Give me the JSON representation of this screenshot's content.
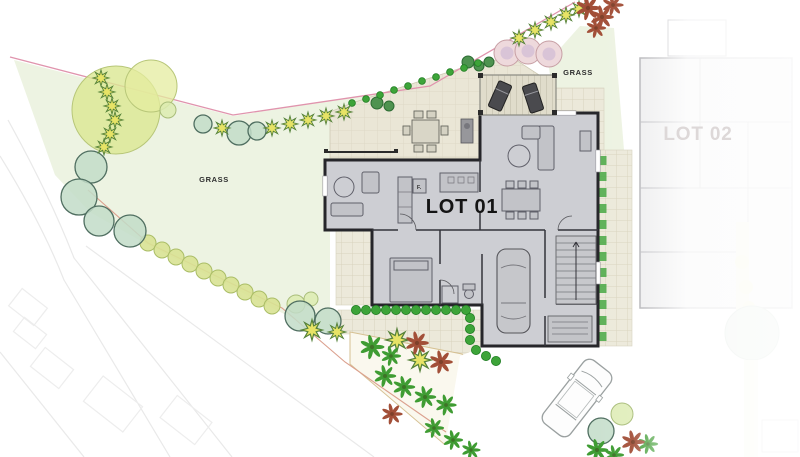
{
  "labels": {
    "lot01": "LOT 01",
    "lot02": "LOT 02",
    "grass_left": "GRASS",
    "grass_right": "GRASS",
    "fridge": "F."
  },
  "colors": {
    "grass": "#edf3e2",
    "boundary_upper": "#e094ad",
    "boundary_lower": "#dba08e",
    "patio": "#eae6d6",
    "paver": "#ece9da",
    "house_fill": "#cdced3",
    "wall": "#26262a",
    "furniture": "#60606a",
    "road_line": "#e9e9e9",
    "tree_teal": "#c2dcc8",
    "tree_teal_stroke": "#4f6e60",
    "tree_light": "#dcebb0",
    "tree_light_stroke": "#a9bd7a",
    "tree_pink": "#eed9dc",
    "tree_pink_stroke": "#c79fa4",
    "tree_pink_inner": "#c9b2d4",
    "hedge_yellow": "#d8e293",
    "hedge_yellow_stroke": "#aabd66",
    "bush_green": "#4e9350",
    "bush_green_stroke": "#2c6b33",
    "hedge_bright": "#3da439",
    "hedge_bright_stroke": "#1f7d22",
    "star_yellow": "#e7e366",
    "palm_green": "#3f9c33",
    "palm_red": "#a24f38",
    "ghost": "#b5b5ba"
  },
  "vegetation": {
    "canopy": [
      {
        "x": 116,
        "y": 110,
        "r": 44,
        "f": "#dbe792",
        "o": 0.8
      },
      {
        "x": 151,
        "y": 86,
        "r": 26,
        "f": "#e4ec9f",
        "o": 0.75
      }
    ],
    "teal": [
      {
        "x": 91,
        "y": 167,
        "r": 16
      },
      {
        "x": 79,
        "y": 197,
        "r": 18
      },
      {
        "x": 99,
        "y": 221,
        "r": 15
      },
      {
        "x": 130,
        "y": 231,
        "r": 16
      },
      {
        "x": 203,
        "y": 124,
        "r": 9
      },
      {
        "x": 239,
        "y": 133,
        "r": 12
      },
      {
        "x": 257,
        "y": 131,
        "r": 9
      },
      {
        "x": 300,
        "y": 316,
        "r": 15
      },
      {
        "x": 328,
        "y": 321,
        "r": 13
      },
      {
        "x": 601,
        "y": 431,
        "r": 13
      }
    ],
    "light": [
      {
        "x": 168,
        "y": 110,
        "r": 8
      },
      {
        "x": 296,
        "y": 304,
        "r": 9
      },
      {
        "x": 311,
        "y": 299,
        "r": 7
      },
      {
        "x": 622,
        "y": 414,
        "r": 11
      }
    ],
    "pink": [
      {
        "x": 507,
        "y": 53,
        "r": 13
      },
      {
        "x": 528,
        "y": 51,
        "r": 13
      },
      {
        "x": 549,
        "y": 54,
        "r": 13
      }
    ],
    "yellow_row": [
      {
        "x": 148,
        "y": 243
      },
      {
        "x": 162,
        "y": 250
      },
      {
        "x": 176,
        "y": 257
      },
      {
        "x": 190,
        "y": 264
      },
      {
        "x": 204,
        "y": 271
      },
      {
        "x": 218,
        "y": 278
      },
      {
        "x": 231,
        "y": 285
      },
      {
        "x": 245,
        "y": 292
      },
      {
        "x": 259,
        "y": 299
      },
      {
        "x": 272,
        "y": 306
      }
    ],
    "stars": [
      {
        "x": 101,
        "y": 78
      },
      {
        "x": 107,
        "y": 92
      },
      {
        "x": 112,
        "y": 106
      },
      {
        "x": 115,
        "y": 120
      },
      {
        "x": 110,
        "y": 134
      },
      {
        "x": 104,
        "y": 147
      },
      {
        "x": 222,
        "y": 128
      },
      {
        "x": 272,
        "y": 128
      },
      {
        "x": 290,
        "y": 124
      },
      {
        "x": 308,
        "y": 120
      },
      {
        "x": 326,
        "y": 116
      },
      {
        "x": 344,
        "y": 112
      },
      {
        "x": 519,
        "y": 38
      },
      {
        "x": 535,
        "y": 30
      },
      {
        "x": 551,
        "y": 22
      },
      {
        "x": 566,
        "y": 15
      },
      {
        "x": 579,
        "y": 9
      },
      {
        "x": 312,
        "y": 330,
        "s": 1.3
      },
      {
        "x": 397,
        "y": 340,
        "s": 1.4
      },
      {
        "x": 420,
        "y": 360,
        "s": 1.4
      },
      {
        "x": 337,
        "y": 332,
        "s": 1.1
      }
    ],
    "bushes": [
      {
        "x": 468,
        "y": 62,
        "r": 6
      },
      {
        "x": 479,
        "y": 66,
        "r": 5
      },
      {
        "x": 489,
        "y": 62,
        "r": 5
      },
      {
        "x": 377,
        "y": 103,
        "r": 6
      },
      {
        "x": 389,
        "y": 106,
        "r": 5
      }
    ],
    "hedge_path": [
      {
        "x": 352,
        "y": 103
      },
      {
        "x": 366,
        "y": 99
      },
      {
        "x": 380,
        "y": 95
      },
      {
        "x": 394,
        "y": 90
      },
      {
        "x": 408,
        "y": 86
      },
      {
        "x": 422,
        "y": 81
      },
      {
        "x": 436,
        "y": 77
      },
      {
        "x": 450,
        "y": 72
      },
      {
        "x": 464,
        "y": 68
      },
      {
        "x": 478,
        "y": 63
      }
    ],
    "hedge_court": [
      {
        "x": 356,
        "y": 310
      },
      {
        "x": 366,
        "y": 310
      },
      {
        "x": 376,
        "y": 310
      },
      {
        "x": 386,
        "y": 310
      },
      {
        "x": 396,
        "y": 310
      },
      {
        "x": 406,
        "y": 310
      },
      {
        "x": 416,
        "y": 310
      },
      {
        "x": 426,
        "y": 310
      },
      {
        "x": 436,
        "y": 310
      },
      {
        "x": 446,
        "y": 310
      },
      {
        "x": 456,
        "y": 310
      },
      {
        "x": 466,
        "y": 310
      },
      {
        "x": 470,
        "y": 318
      },
      {
        "x": 470,
        "y": 329
      },
      {
        "x": 470,
        "y": 340
      },
      {
        "x": 476,
        "y": 350
      },
      {
        "x": 486,
        "y": 356
      },
      {
        "x": 496,
        "y": 361
      }
    ],
    "palms_green": [
      {
        "x": 372,
        "y": 347,
        "s": 1.1
      },
      {
        "x": 391,
        "y": 356,
        "s": 0.9
      },
      {
        "x": 385,
        "y": 376,
        "s": 1
      },
      {
        "x": 404,
        "y": 387,
        "s": 1
      },
      {
        "x": 425,
        "y": 397,
        "s": 1
      },
      {
        "x": 446,
        "y": 405,
        "s": 0.95
      },
      {
        "x": 434,
        "y": 428,
        "s": 0.9
      },
      {
        "x": 453,
        "y": 440,
        "s": 0.9
      },
      {
        "x": 471,
        "y": 450,
        "s": 0.85
      },
      {
        "x": 597,
        "y": 450,
        "s": 1
      },
      {
        "x": 614,
        "y": 455,
        "s": 0.9
      },
      {
        "x": 648,
        "y": 444,
        "s": 0.9
      }
    ],
    "palms_red": [
      {
        "x": 417,
        "y": 343,
        "s": 1.05
      },
      {
        "x": 441,
        "y": 362,
        "s": 1.05
      },
      {
        "x": 392,
        "y": 414,
        "s": 0.95
      },
      {
        "x": 633,
        "y": 442,
        "s": 1.05
      },
      {
        "x": 588,
        "y": 8,
        "s": 1.1
      },
      {
        "x": 602,
        "y": 17,
        "s": 1.05
      },
      {
        "x": 613,
        "y": 5,
        "s": 0.95
      },
      {
        "x": 596,
        "y": 28,
        "s": 0.9
      }
    ]
  }
}
